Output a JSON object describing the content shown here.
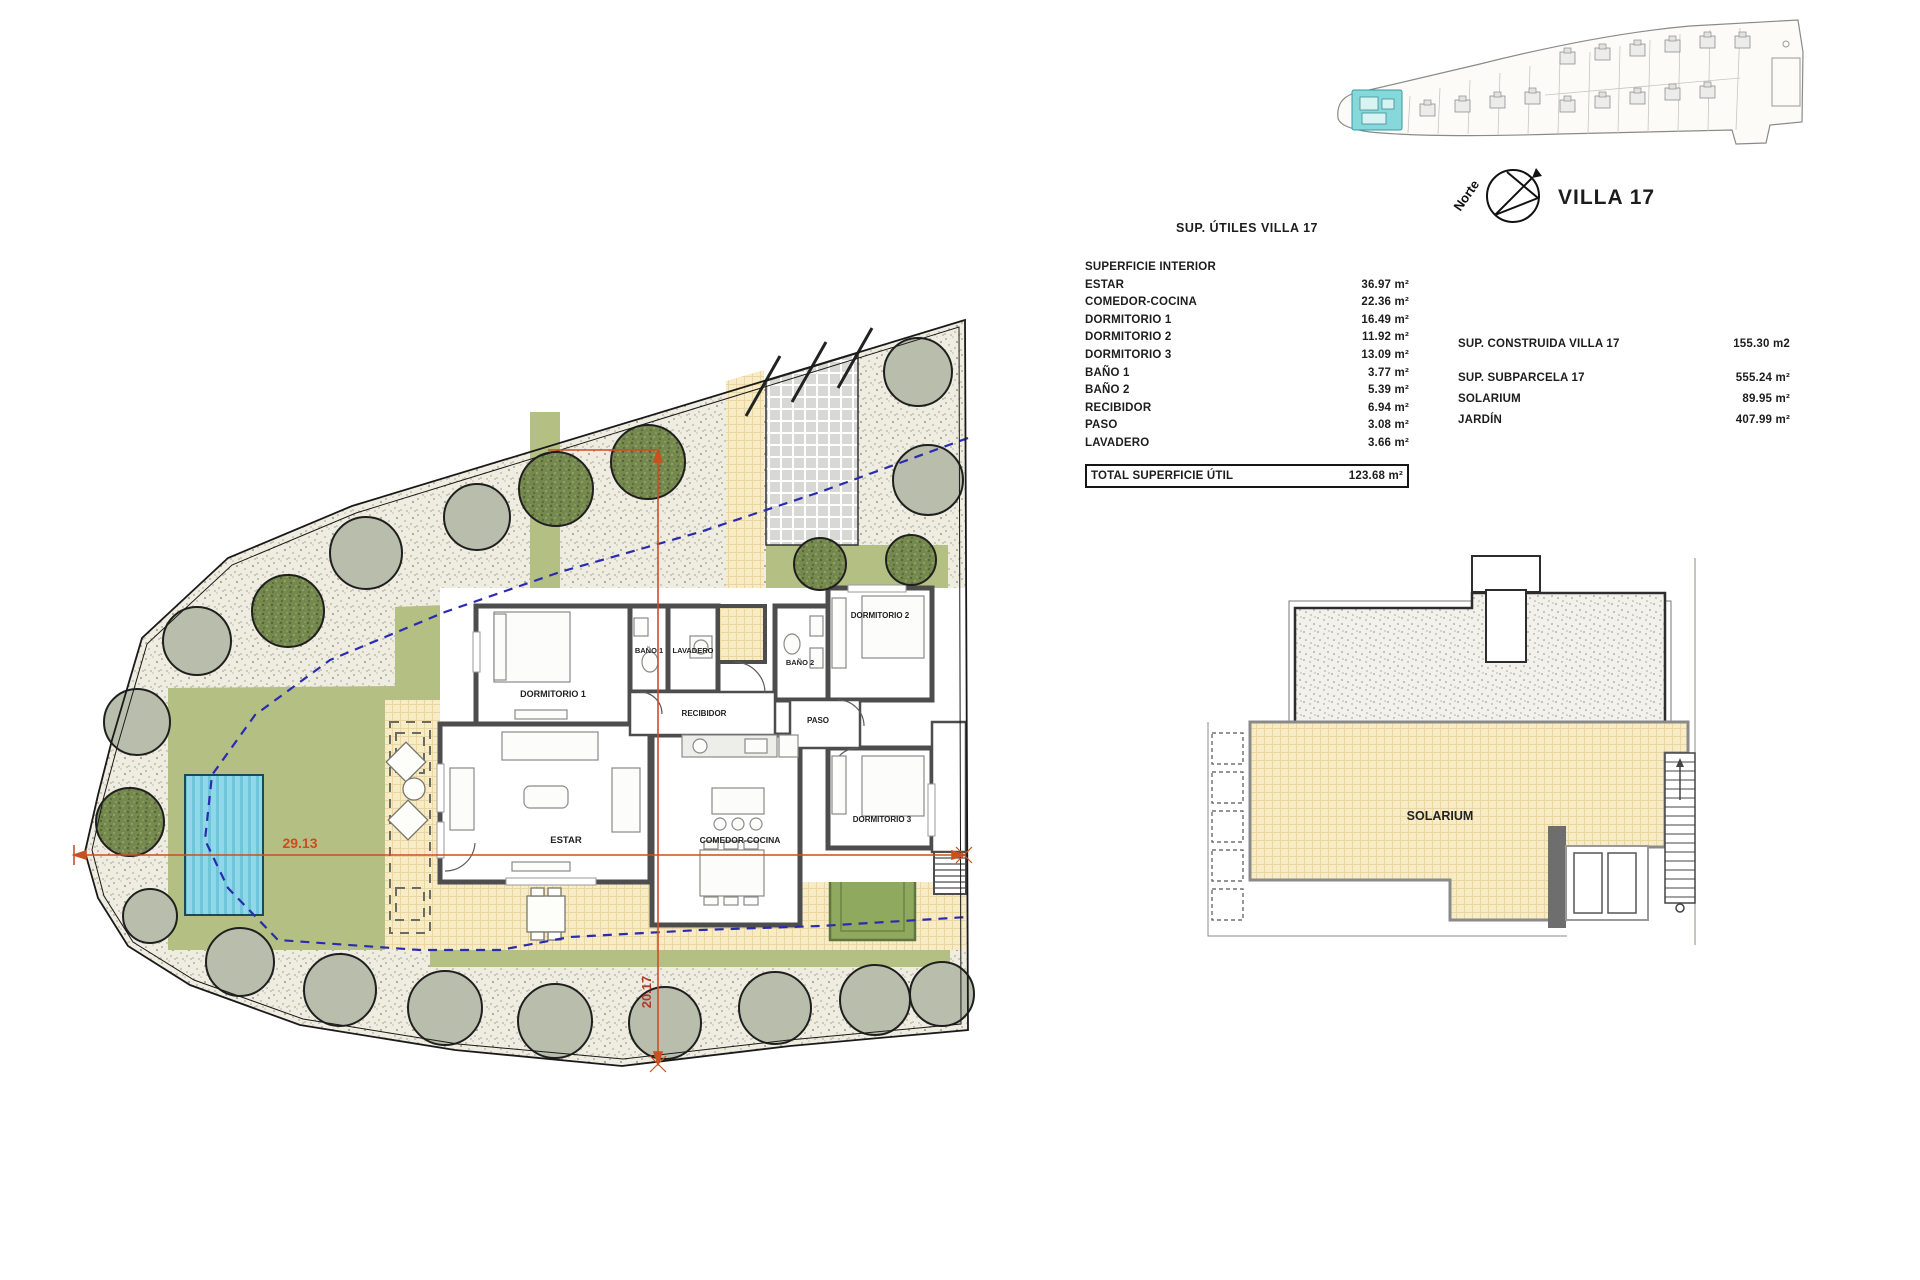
{
  "sheet_title": "VILLA 17",
  "north_arrow": {
    "label": "Norte"
  },
  "areas_table": {
    "title": "SUP. ÚTILES VILLA 17",
    "rows": [
      {
        "label": "SUPERFICIE INTERIOR",
        "value": ""
      },
      {
        "label": "ESTAR",
        "value": "36.97 m²"
      },
      {
        "label": "COMEDOR-COCINA",
        "value": "22.36 m²"
      },
      {
        "label": "DORMITORIO 1",
        "value": "16.49 m²"
      },
      {
        "label": "DORMITORIO 2",
        "value": "11.92 m²"
      },
      {
        "label": "DORMITORIO 3",
        "value": "13.09 m²"
      },
      {
        "label": "BAÑO 1",
        "value": "3.77 m²"
      },
      {
        "label": "BAÑO 2",
        "value": "5.39 m²"
      },
      {
        "label": "RECIBIDOR",
        "value": "6.94 m²"
      },
      {
        "label": "PASO",
        "value": "3.08 m²"
      },
      {
        "label": "LAVADERO",
        "value": "3.66 m²"
      }
    ],
    "total": {
      "label": "TOTAL SUPERFICIE ÚTIL",
      "value": "123.68 m²"
    }
  },
  "summary": {
    "rows": [
      {
        "label": "SUP. CONSTRUIDA VILLA 17",
        "value": "155.30 m2"
      },
      {
        "label": "SUP. SUBPARCELA 17",
        "value": "555.24 m²"
      },
      {
        "label": "SOLARIUM",
        "value": "89.95 m²"
      },
      {
        "label": "JARDÍN",
        "value": "407.99 m²"
      }
    ]
  },
  "floor_plan": {
    "rooms": [
      {
        "label": "DORMITORIO 1"
      },
      {
        "label": "BAÑO 1"
      },
      {
        "label": "LAVADERO"
      },
      {
        "label": "BAÑO 2"
      },
      {
        "label": "DORMITORIO 2"
      },
      {
        "label": "RECIBIDOR"
      },
      {
        "label": "PASO"
      },
      {
        "label": "ESTAR"
      },
      {
        "label": "COMEDOR-COCINA"
      },
      {
        "label": "DORMITORIO 3"
      }
    ],
    "dimensions": {
      "width": "29.13",
      "depth": "20.17"
    }
  },
  "solarium_plan": {
    "label": "SOLARIUM"
  },
  "colors": {
    "garden_green": "#b4c083",
    "terrace_yellow": "#f8ecc6",
    "pool_cyan": "#8fd8e9",
    "wall_gray": "#4d4d4d",
    "dimension_orange": "#c8511f",
    "setback_blue": "#2b2bb0",
    "highlight_cyan": "#86d8da"
  }
}
